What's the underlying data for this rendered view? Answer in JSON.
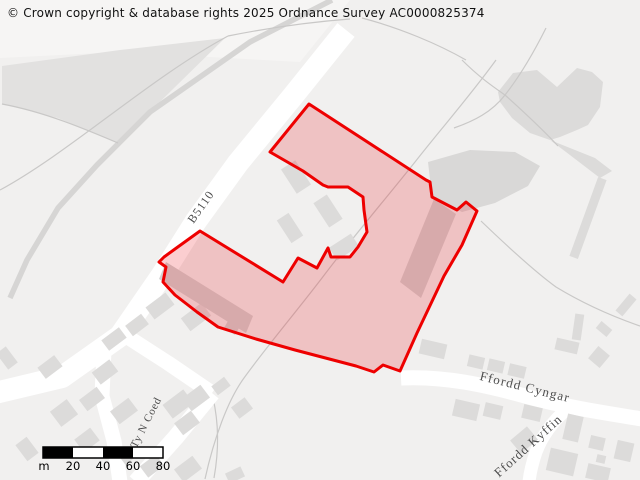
{
  "copyright": {
    "text": "© Crown copyright & database rights 2025 Ordnance Survey AC0000825374"
  },
  "map": {
    "colors": {
      "background": "#f1f0ef",
      "light_area": "#f6f5f4",
      "field_wedge": "#e2e1e0",
      "gray_area": "#dcdbda",
      "building": "#dcdbda",
      "building_inner": "#d3d2d1",
      "road": "#ffffff",
      "track": "#d6d5d4",
      "boundary_line": "#c9c8c7",
      "selection_stroke": "#ee0000",
      "selection_fill": "rgba(235,10,20,0.20)",
      "label_text": "#4d4d4d"
    },
    "areas": [
      {
        "id": "light-top-left",
        "points": "0,0 350,0 300,62 120,52 0,58",
        "fill": "#f6f5f4"
      },
      {
        "id": "field-wedge",
        "points": "2,66 120,50 225,38 118,143 58,118 2,104",
        "fill": "#e2e1e0"
      },
      {
        "id": "gray-blob-topright",
        "points": "498,92 513,73 537,70 557,87 577,68 592,72 603,82 600,107 588,125 577,130 560,137 550,140 530,133 512,118 500,102",
        "fill": "#dcdbda"
      },
      {
        "id": "gray-blob-tail",
        "points": "550,140 595,158 612,171 600,178 566,152",
        "fill": "#dcdbda"
      },
      {
        "id": "gray-area-right-of-site",
        "points": "428,162 470,150 515,152 540,166 528,186 495,203 462,212 432,197",
        "fill": "#d9d8d7"
      }
    ],
    "track_lines": [
      {
        "id": "field-track",
        "d": "M332,0 L250,42 L150,112 L97,165 L58,208 L27,260 L10,298",
        "width": 5.5,
        "color": "#d6d5d4"
      }
    ],
    "thin_lines": [
      {
        "id": "boundary-through-site",
        "d": "M496,60 C470,96 440,130 415,162 C388,196 352,238 322,278 C296,312 264,350 244,378 C228,400 214,438 205,479"
      },
      {
        "id": "boundary-east",
        "d": "M481,221 C506,245 534,271 556,287 C584,304 614,317 640,326"
      },
      {
        "id": "boundary-ne-1",
        "d": "M546,28 C530,60 516,81 505,95 C492,112 474,121 454,128"
      },
      {
        "id": "boundary-ne-2",
        "d": "M462,60 C480,78 495,88 505,95 C525,113 545,132 558,146"
      },
      {
        "id": "boundary-nw-1",
        "d": "M0,190 C70,152 150,78 228,36"
      },
      {
        "id": "boundary-nw-2",
        "d": "M228,36 C268,28 310,22 350,19"
      },
      {
        "id": "boundary-nw-3",
        "d": "M362,18 C400,28 438,44 466,60"
      },
      {
        "id": "wedge-edge",
        "d": "M2,104 C45,112 85,129 118,143"
      },
      {
        "id": "boundary-sw",
        "d": "M213,398 C219,424 219,450 214,478"
      }
    ],
    "roads": [
      {
        "id": "road-b5110",
        "d": "M346,30 L293,96 L238,163 L196,221 L162,275 L120,336 L62,377 L-5,393",
        "width": 22
      },
      {
        "id": "road-estate",
        "d": "M120,332 L168,363 L212,393",
        "width": 15
      },
      {
        "id": "road-ty-n-coed",
        "d": "M212,393 L176,437 L136,482",
        "width": 17
      },
      {
        "id": "road-fork-south",
        "d": "M104,350 L102,396 L114,441 L120,482",
        "width": 15
      },
      {
        "id": "road-ffordd-cyngar",
        "d": "M401,378 C445,376 485,385 525,396 C565,407 605,413 642,419",
        "width": 15
      },
      {
        "id": "road-ffordd-kyffin",
        "d": "M567,409 C552,422 542,436 536,452 C532,464 530,472 529,482",
        "width": 13
      }
    ],
    "buildings": [
      [
        114,
        339,
        22,
        13,
        -37
      ],
      [
        137,
        325,
        20,
        13,
        -37
      ],
      [
        160,
        306,
        25,
        15,
        -37
      ],
      [
        196,
        317,
        26,
        16,
        -37
      ],
      [
        105,
        372,
        22,
        15,
        -37
      ],
      [
        50,
        367,
        21,
        14,
        -37
      ],
      [
        7,
        358,
        12,
        20,
        -37
      ],
      [
        64,
        413,
        21,
        19,
        -37
      ],
      [
        92,
        399,
        22,
        14,
        -37
      ],
      [
        124,
        411,
        23,
        16,
        -37
      ],
      [
        87,
        440,
        20,
        16,
        -37
      ],
      [
        27,
        449,
        14,
        20,
        -37
      ],
      [
        178,
        404,
        26,
        17,
        -37
      ],
      [
        127,
        456,
        13,
        12,
        -37
      ],
      [
        152,
        466,
        20,
        14,
        -37
      ],
      [
        188,
        469,
        23,
        16,
        -37
      ],
      [
        196,
        398,
        23,
        16,
        -37
      ],
      [
        187,
        423,
        21,
        15,
        -37
      ],
      [
        221,
        386,
        16,
        11,
        -37
      ],
      [
        242,
        408,
        17,
        14,
        -37
      ],
      [
        235,
        475,
        17,
        11,
        -25
      ],
      [
        433,
        349,
        26,
        15,
        13
      ],
      [
        476,
        362,
        16,
        12,
        13
      ],
      [
        496,
        366,
        16,
        12,
        13
      ],
      [
        517,
        371,
        17,
        12,
        13
      ],
      [
        567,
        346,
        23,
        12,
        13
      ],
      [
        599,
        357,
        15,
        16,
        40
      ],
      [
        466,
        410,
        25,
        17,
        13
      ],
      [
        493,
        411,
        18,
        14,
        13
      ],
      [
        532,
        413,
        19,
        14,
        13
      ],
      [
        524,
        440,
        22,
        17,
        -40
      ],
      [
        573,
        428,
        16,
        26,
        13
      ],
      [
        597,
        443,
        15,
        13,
        13
      ],
      [
        601,
        459,
        9,
        8,
        13
      ],
      [
        562,
        462,
        28,
        23,
        13
      ],
      [
        598,
        473,
        23,
        15,
        13
      ],
      [
        624,
        451,
        17,
        19,
        13
      ],
      [
        588,
        218,
        9,
        84,
        20
      ],
      [
        578,
        327,
        9,
        26,
        8
      ],
      [
        604,
        329,
        14,
        9,
        40
      ],
      [
        626,
        305,
        9,
        22,
        40
      ],
      [
        328,
        211,
        16,
        29,
        -33
      ],
      [
        290,
        228,
        14,
        27,
        -33
      ],
      [
        344,
        247,
        26,
        15,
        -33
      ],
      [
        296,
        177,
        17,
        29,
        -33
      ]
    ],
    "inner_features": [
      {
        "id": "site-building-west",
        "points": "166,262 253,316 246,333 159,279",
        "fill": "#d3d2d1"
      },
      {
        "id": "site-building-east",
        "points": "434,199 456,214 421,298 400,282",
        "fill": "#d3d2d1"
      },
      {
        "id": "site-building-small",
        "points": "228,321 239,328 235,335 224,328",
        "fill": "#d3d2d1"
      }
    ],
    "selection": {
      "points": "309,104 426,180 430,182 432,197 457,210 466,202 477,211 462,245 444,276 417,333 400,371 383,365 374,372 356,366 295,350 256,339 218,327 197,312 175,295 163,282 166,267 159,262 164,257 175,249 200,231 283,282 298,258 317,268 328,248 331,257 350,257 358,247 367,232 364,210 363,197 348,187 328,187 323,185 303,171 270,152",
      "stroke": "#ee0000",
      "stroke_width": 3,
      "fill": "rgba(235,10,20,0.20)"
    },
    "labels": [
      {
        "id": "road-label-b5110",
        "text": "B5110",
        "x": 204,
        "y": 209,
        "rot": -55,
        "size": 12,
        "ls": 1
      },
      {
        "id": "road-label-ffordd-cyngar",
        "text": "Ffordd Cyngar",
        "x": 524,
        "y": 391,
        "rot": 14,
        "size": 13,
        "ls": 1.2
      },
      {
        "id": "road-label-ffordd-kyffin",
        "text": "Ffordd Kyffin",
        "x": 531,
        "y": 449,
        "rot": -42,
        "size": 13,
        "ls": 1
      },
      {
        "id": "road-label-ty-n-coed",
        "text": "Ty N Coed",
        "x": 149,
        "y": 424,
        "rot": -63,
        "size": 11,
        "ls": 0.8
      }
    ],
    "scalebar": {
      "x": 43,
      "y": 447,
      "segment_width": 30,
      "height": 11,
      "segments": 4,
      "unit": "m",
      "tick_labels": [
        "20",
        "40",
        "60",
        "80"
      ],
      "label_y": 470,
      "font_size": 11.5
    }
  }
}
